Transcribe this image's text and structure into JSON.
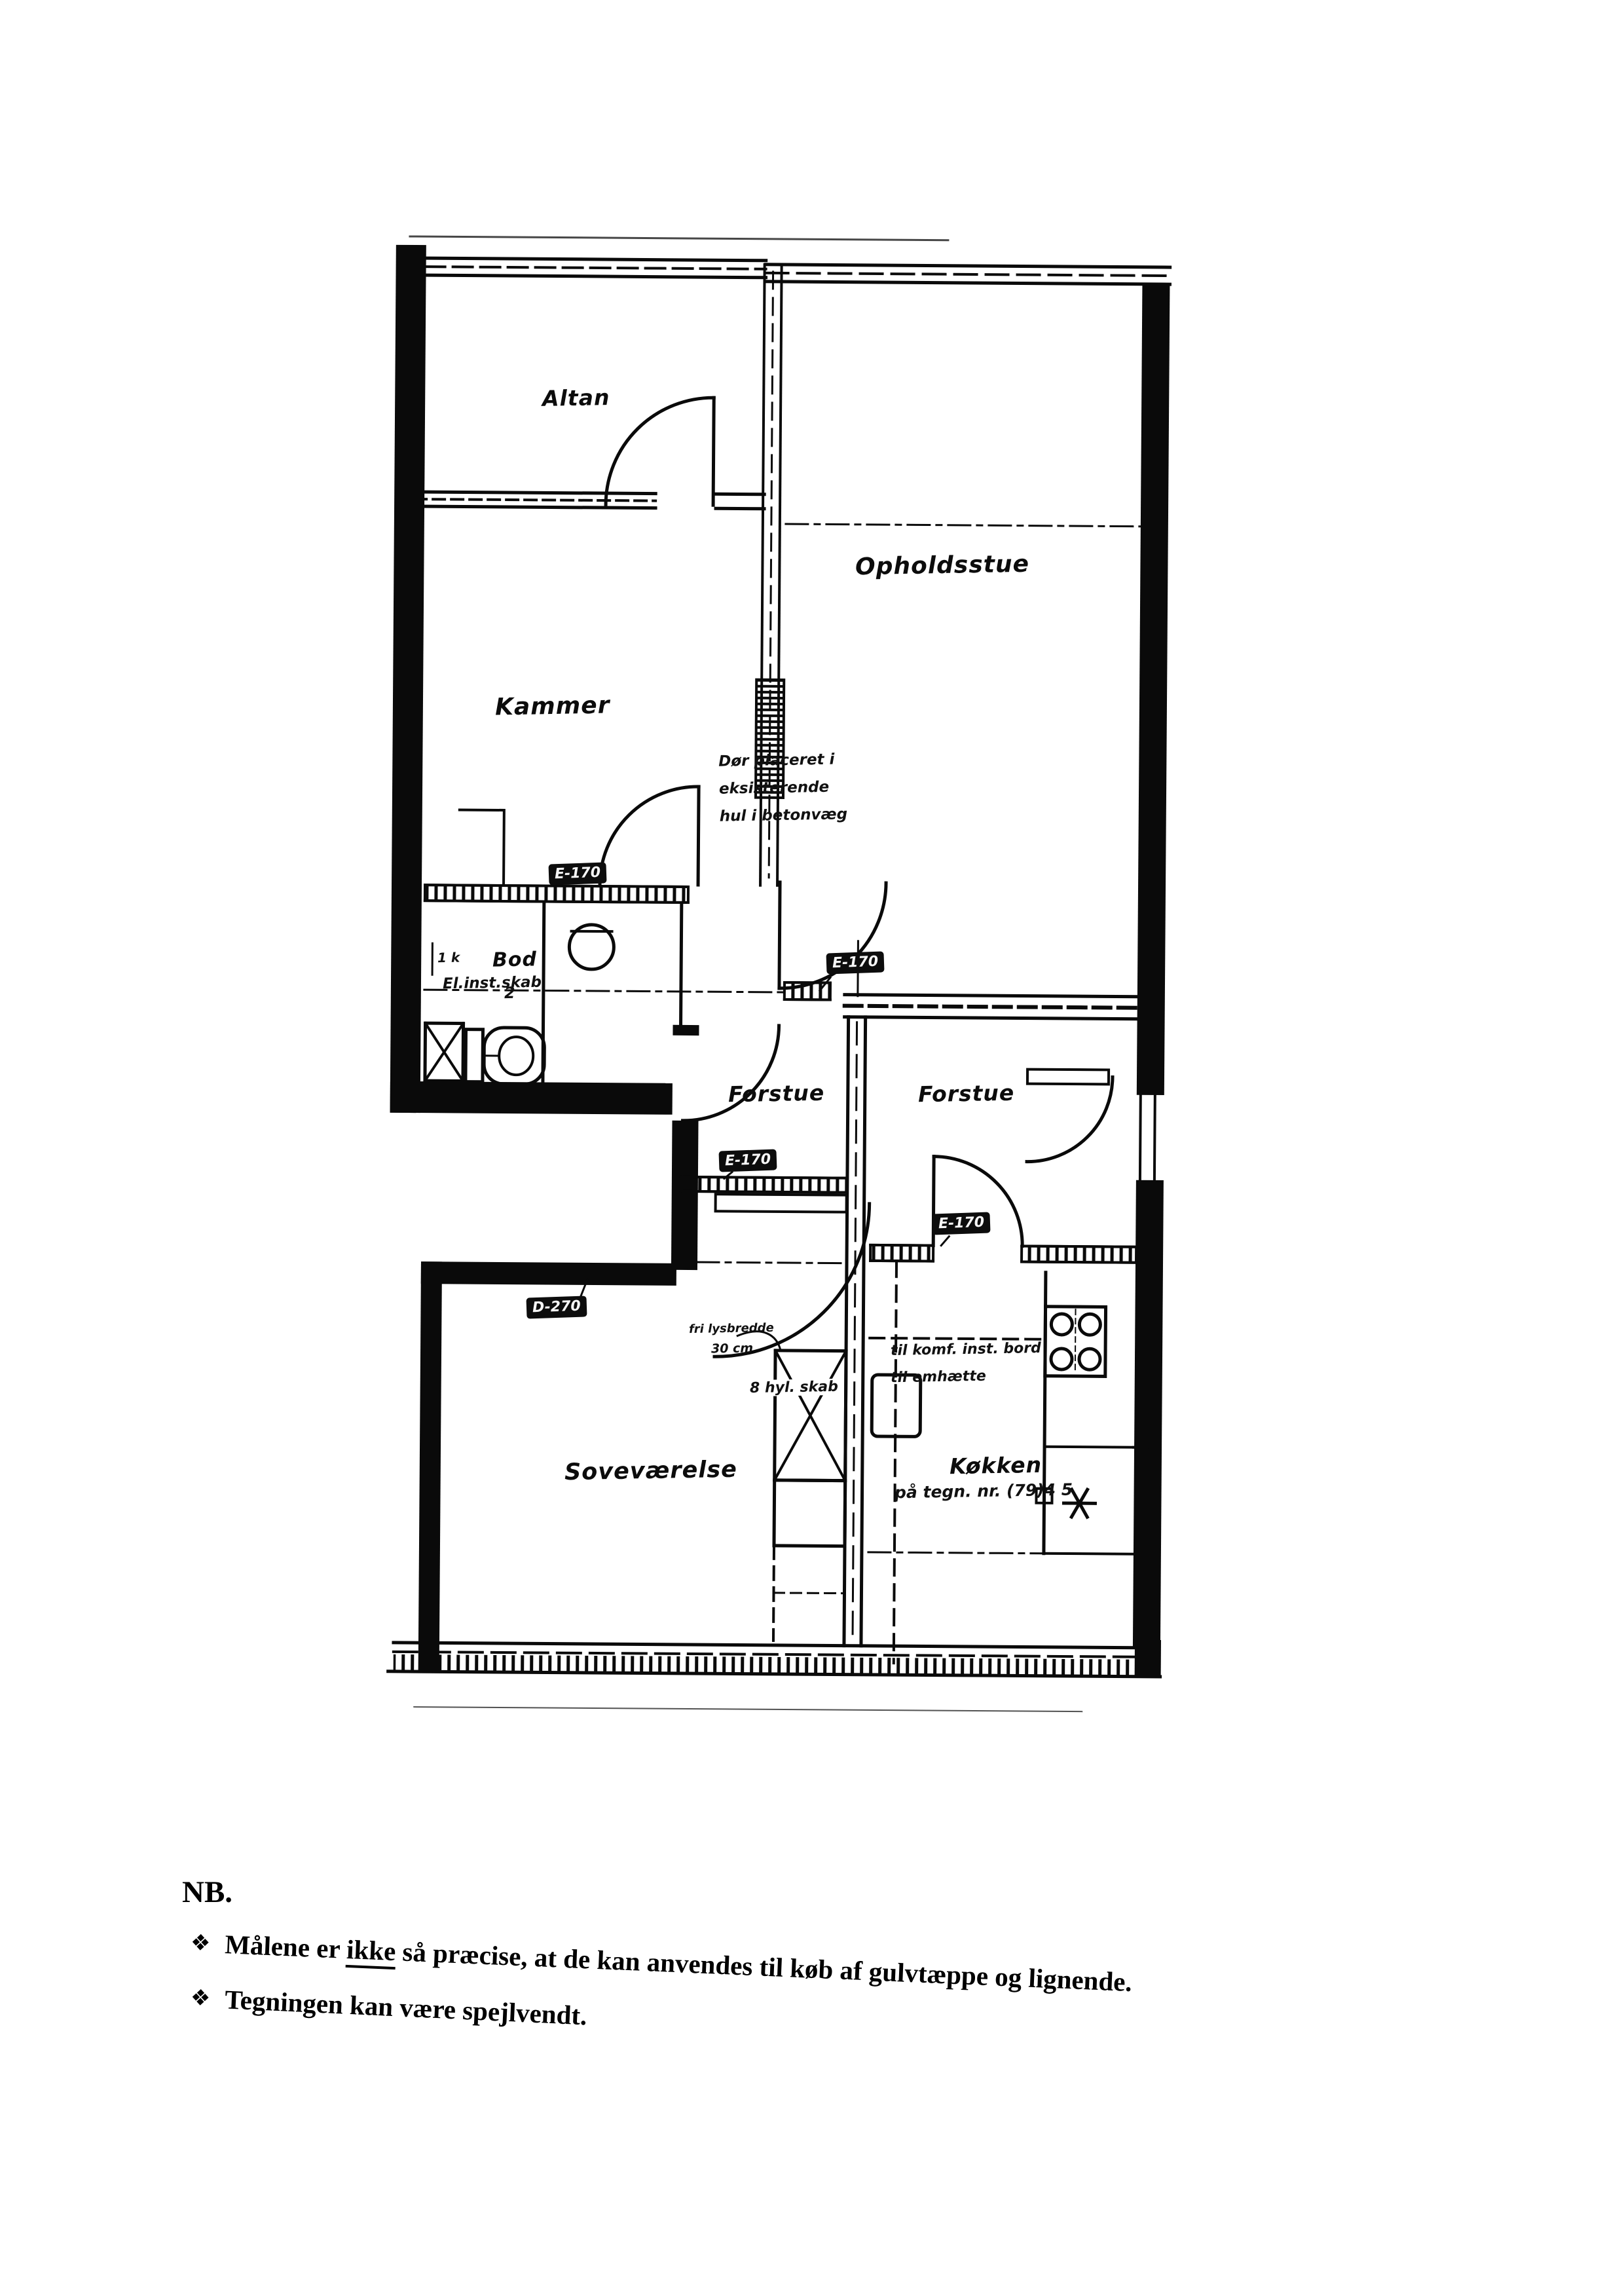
{
  "page": {
    "background": "#ffffff",
    "ink": "#000000"
  },
  "plan": {
    "rooms": {
      "altan": {
        "label": "Altan"
      },
      "opholdsstue": {
        "label": "Opholdsstue"
      },
      "kammer": {
        "label": "Kammer"
      },
      "bod": {
        "label": "Bod",
        "mark": "2"
      },
      "forstue_left": {
        "label": "Forstue"
      },
      "forstue_right": {
        "label": "Forstue"
      },
      "sovevaerelse": {
        "label": "Soveværelse"
      },
      "koekken": {
        "label": "Køkken"
      }
    },
    "door_tags": {
      "kammer": {
        "label": "E-170"
      },
      "stue": {
        "label": "E-170"
      },
      "forstue_left": {
        "label": "E-170"
      },
      "koekken": {
        "label": "E-170"
      },
      "sovevaerelse": {
        "label": "D-270"
      }
    },
    "annotations": {
      "wall_note_line1": "Dør placeret i",
      "wall_note_line2": "eksisterende",
      "wall_note_line3": "hul i betonvæg",
      "el_cabinet": "El.inst.skab",
      "left_mark": "1 k",
      "closet_width_line1": "fri lysbredde",
      "closet_width_line2": "30 cm",
      "closet_label": "8 hyl. skab",
      "kitchen_note_line1": "til komf. inst. bord",
      "kitchen_note_line2": "til emhætte",
      "kitchen_ref": "på tegn. nr. (79)4 5"
    },
    "fixtures": [
      "wc-pan",
      "toilet",
      "shower",
      "wardrobe",
      "refrigerator",
      "stove",
      "ceiling-lamp",
      "window",
      "door-swing"
    ]
  },
  "footer": {
    "title": "NB.",
    "bullet": "❖",
    "note1_pre": "Målene er ",
    "note1_underlined": "ikke",
    "note1_post": " så præcise, at de kan anvendes til køb af gulvtæppe og lignende.",
    "note2": "Tegningen kan være spejlvendt."
  }
}
